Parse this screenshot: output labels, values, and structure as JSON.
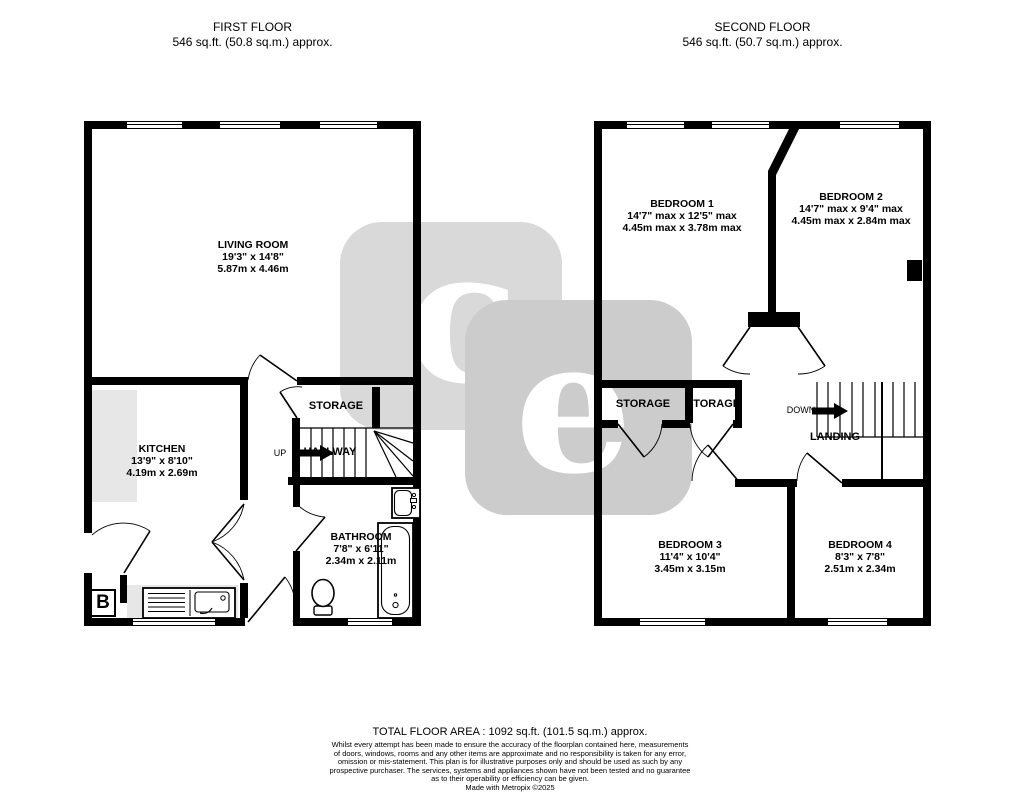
{
  "first_floor": {
    "title": "FIRST FLOOR",
    "area": "546 sq.ft. (50.8 sq.m.) approx."
  },
  "second_floor": {
    "title": "SECOND FLOOR",
    "area": "546 sq.ft. (50.7 sq.m.) approx."
  },
  "rooms": {
    "living": {
      "name": "LIVING ROOM",
      "imperial": "19'3\"  x 14'8\"",
      "metric": "5.87m  x 4.46m"
    },
    "kitchen": {
      "name": "KITCHEN",
      "imperial": "13'9\"  x 8'10\"",
      "metric": "4.19m  x 2.69m"
    },
    "bathroom": {
      "name": "BATHROOM",
      "imperial": "7'8\"  x 6'11\"",
      "metric": "2.34m  x 2.11m"
    },
    "bedroom1": {
      "name": "BEDROOM 1",
      "imperial": "14'7\" max x 12'5\" max",
      "metric": "4.45m max x 3.78m max"
    },
    "bedroom2": {
      "name": "BEDROOM 2",
      "imperial": "14'7\" max x 9'4\" max",
      "metric": "4.45m max x 2.84m max"
    },
    "bedroom3": {
      "name": "BEDROOM 3",
      "imperial": "11'4\"  x 10'4\"",
      "metric": "3.45m  x 3.15m"
    },
    "bedroom4": {
      "name": "BEDROOM 4",
      "imperial": "8'3\"  x 7'8\"",
      "metric": "2.51m  x 2.34m"
    }
  },
  "labels": {
    "storage": "STORAGE",
    "hallway": "HALLWAY",
    "landing": "LANDING",
    "up": "UP",
    "down": "DOWN",
    "boiler": "B"
  },
  "watermark": {
    "letter1": "c",
    "letter2": "e",
    "color1": "#d9d9d9",
    "color2": "#cccccc"
  },
  "footer": {
    "total_area": "TOTAL FLOOR AREA : 1092 sq.ft. (101.5 sq.m.) approx.",
    "disclaimer": [
      "Whilst every attempt has been made to ensure the accuracy of the floorplan contained here, measurements",
      "of doors, windows, rooms and any other items are approximate and no responsibility is taken for any error,",
      "omission or mis-statement. This plan is for illustrative purposes only and should be used as such by any",
      "prospective purchaser. The services, systems and appliances shown have not been tested and no guarantee",
      "as to their operability or efficiency can be given."
    ],
    "credit": "Made with Metropix ©2025"
  }
}
